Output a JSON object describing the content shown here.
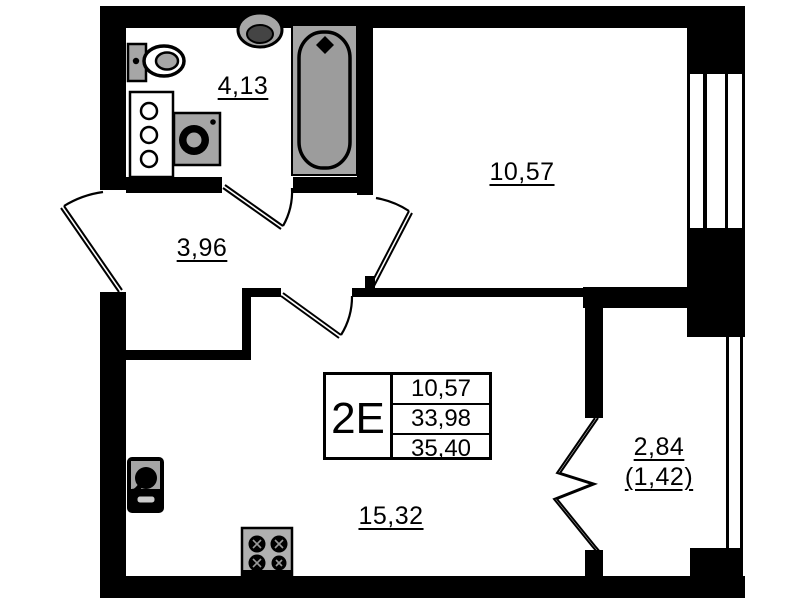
{
  "colors": {
    "wall": "#000000",
    "fixture_gray": "#a6a6a6",
    "fixture_dark": "#444444",
    "background": "#ffffff"
  },
  "unit_box": {
    "type_label": "2E",
    "values": [
      "10,57",
      "33,98",
      "35,40"
    ]
  },
  "rooms": {
    "bathroom": {
      "area": "4,13"
    },
    "hallway": {
      "area": "3,96"
    },
    "bedroom": {
      "area": "10,57"
    },
    "living_kitchen": {
      "area": "15,32"
    },
    "balcony": {
      "area": "2,84",
      "area_coeff": "(1,42)"
    }
  },
  "icons": [
    "toilet-icon",
    "washbasin-icon",
    "bathtub-icon",
    "washing-machine-icon",
    "vanity-cabinet-icon",
    "kitchen-sink-icon",
    "stove-icon",
    "window-icon",
    "door-swing-icon",
    "balcony-door-icon"
  ]
}
